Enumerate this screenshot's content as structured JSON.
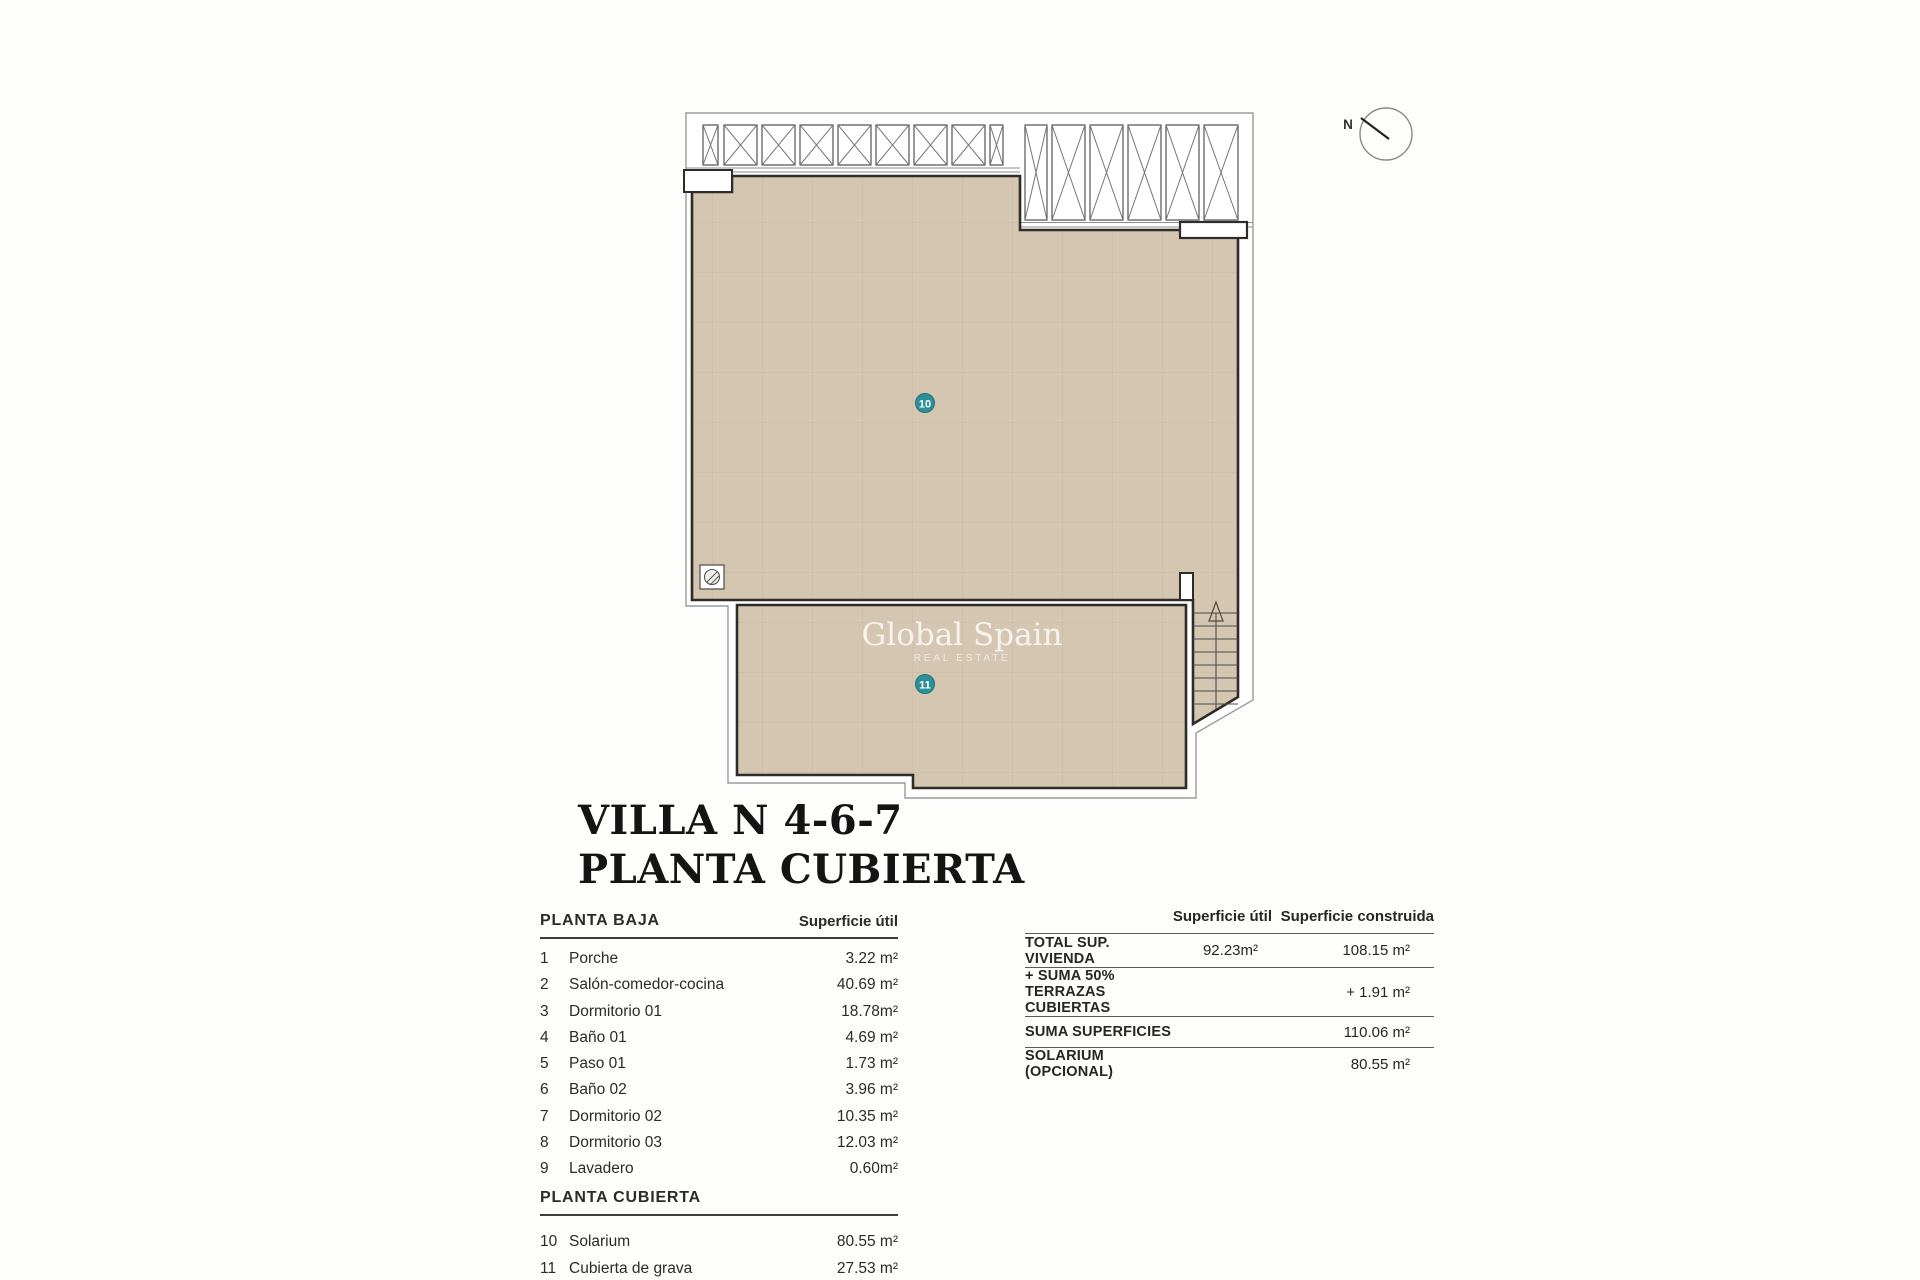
{
  "title": {
    "line1": "VILLA N 4-6-7",
    "line2": "PLANTA CUBIERTA"
  },
  "plan": {
    "compass_label": "N",
    "watermark": {
      "line1": "Global Spain",
      "line2": "REAL ESTATE"
    },
    "markers": {
      "solarium": "10",
      "gravel_roof": "11"
    },
    "colors": {
      "tile_fill": "#d4c6b1",
      "tile_grid": "#c6b7a1",
      "wall": "#2e2b28",
      "outline": "#9b9b9b",
      "marker_teal": "#2d8f98"
    }
  },
  "left_table": {
    "section1": "PLANTA BAJA",
    "col_header": "Superficie útil",
    "rows1": [
      {
        "num": "1",
        "name": "Porche",
        "value": "3.22 m²"
      },
      {
        "num": "2",
        "name": "Salón-comedor-cocina",
        "value": "40.69 m²"
      },
      {
        "num": "3",
        "name": "Dormitorio 01",
        "value": "18.78m²"
      },
      {
        "num": "4",
        "name": "Baño 01",
        "value": "4.69 m²"
      },
      {
        "num": "5",
        "name": "Paso 01",
        "value": "1.73 m²"
      },
      {
        "num": "6",
        "name": "Baño 02",
        "value": "3.96 m²"
      },
      {
        "num": "7",
        "name": "Dormitorio 02",
        "value": "10.35 m²"
      },
      {
        "num": "8",
        "name": "Dormitorio 03",
        "value": "12.03 m²"
      },
      {
        "num": "9",
        "name": "Lavadero",
        "value": "0.60m²"
      }
    ],
    "section2": "PLANTA CUBIERTA",
    "rows2": [
      {
        "num": "10",
        "name": "Solarium",
        "value": "80.55 m²"
      },
      {
        "num": "11",
        "name": "Cubierta de grava",
        "value": "27.53 m²"
      }
    ]
  },
  "right_table": {
    "col1_header": "Superficie útil",
    "col2_header": "Superficie construida",
    "rows": [
      {
        "label": "TOTAL SUP. VIVIENDA",
        "util": "92.23m²",
        "construida": "108.15 m²"
      },
      {
        "label": "+ SUMA 50% TERRAZAS CUBIERTAS",
        "util": "",
        "construida": "+ 1.91 m²"
      },
      {
        "label": "SUMA SUPERFICIES",
        "util": "",
        "construida": "110.06 m²"
      },
      {
        "label": "SOLARIUM (OPCIONAL)",
        "util": "",
        "construida": "80.55 m²"
      }
    ]
  }
}
